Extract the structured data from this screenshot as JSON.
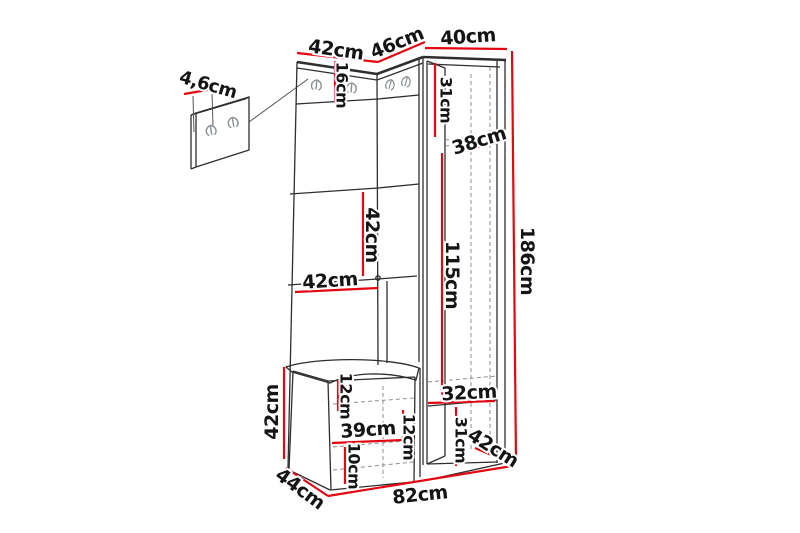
{
  "colors": {
    "dimension": "#e30613",
    "outline": "#2e2e2e",
    "edge": "#3a3a3a",
    "hidden": "#8e8e8e",
    "hook": "#8a9097",
    "background": "#ffffff"
  },
  "diagram": {
    "kind": "furniture-dimension-drawing",
    "unit": "cm",
    "dims": {
      "top_left_width": "42cm",
      "top_corner_width": "46cm",
      "top_right_depth": "40cm",
      "wall_panel_thickness": "4,6cm",
      "hook_panel_height": "16cm",
      "upper_niche_height": "31cm",
      "upper_niche_depth": "38cm",
      "shelf_spacing": "42cm",
      "shelf_width": "42cm",
      "tall_niche_height": "115cm",
      "total_height": "186cm",
      "bench_height": "42cm",
      "seat_height": "12cm",
      "bench_inner_width": "39cm",
      "bench_inner_height": "12cm",
      "plinth_height": "10cm",
      "lower_niche_depth": "32cm",
      "lower_right_height": "31cm",
      "lower_right_depth": "42cm",
      "bench_depth": "44cm",
      "total_width": "82cm"
    }
  }
}
